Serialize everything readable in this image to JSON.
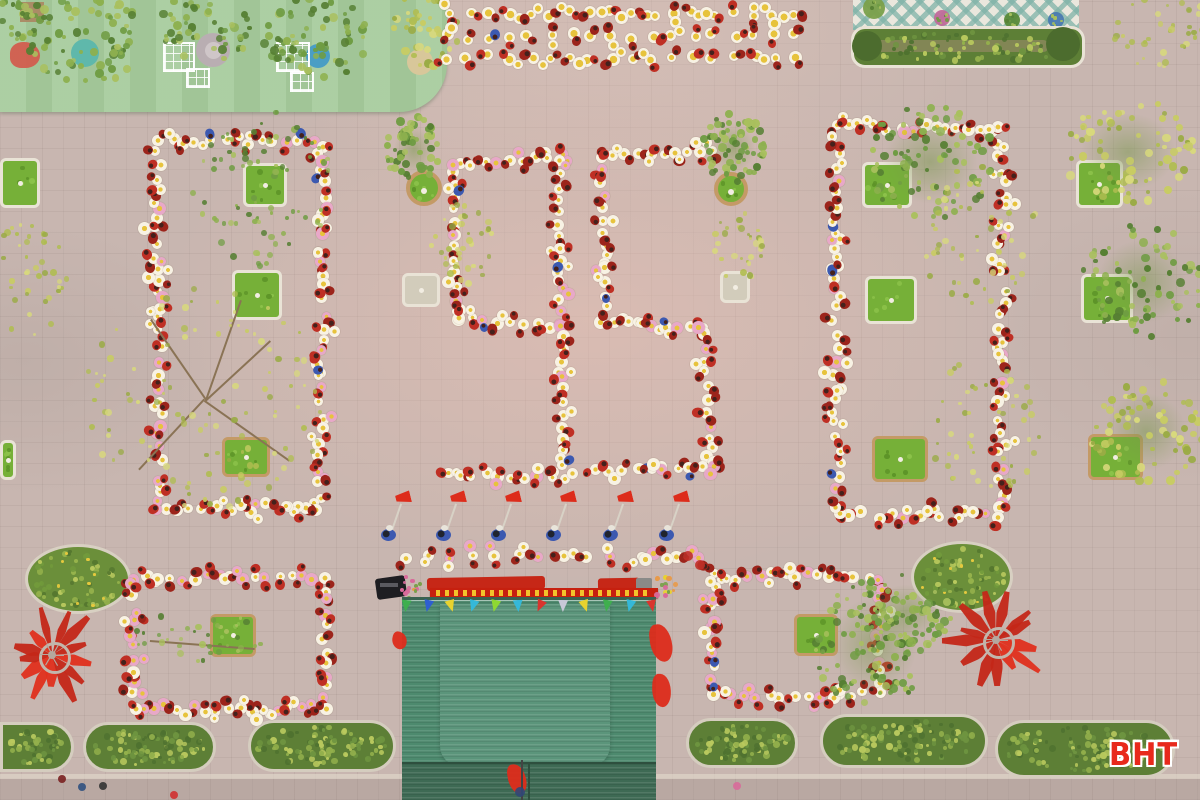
{
  "meta": {
    "watermark": "BHT",
    "scene_description": "Aerial drone photograph of schoolchildren in red outfits holding white and yellow flower props, arranged on a pink-grey paved schoolyard to form the number 95, flanked by rectangular student formations around tree planters, with a green corrugated stage roof, flag bearers, hedges, round shrub planters and red fan decorations"
  },
  "palette": {
    "paving": "#c8b6b0",
    "playground_mat": "#a6cb9c",
    "grass": "#76b038",
    "grass_dark": "#5d9428",
    "curb_white": "#e9e3d6",
    "curb_tan": "#c49a66",
    "hedge_base": "#5d7f36",
    "hedge_greens": [
      "#4f7230",
      "#6e9440",
      "#93b04c",
      "#b9c95e"
    ],
    "bush_base": "#6b8f3a",
    "bush_greens": [
      "#55772f",
      "#729a3c",
      "#97b34c",
      "#b9c95e"
    ],
    "bush_flower": "#e5c93e",
    "tree_green": [
      "#6f9c43",
      "#8db04e",
      "#567f33",
      "#a9c05e"
    ],
    "tree_yellow": [
      "#c8cc63",
      "#b0bd51",
      "#d8d97c",
      "#9aab45"
    ],
    "student_red": "#bf2f24",
    "student_red_dark": "#9c241b",
    "student_head": "#44211c",
    "student_blue": "#3c59b0",
    "flower_white": "#f8f2e4",
    "flower_pink": "#e8a8c8",
    "flower_yellow": "#e7c33c",
    "flag_red": "#dd2c1b",
    "roof": "#4d8a6e",
    "roof_light": "#5b957b",
    "roof_dark": "#3e6a54",
    "roof_seam": "#2e4f3e",
    "banner_red": "#c6200f",
    "banner_gold": "#f2c32c",
    "patio_bg": "#eae7dd",
    "patio_tile": "#7fb3a8",
    "branch": "#8a7355",
    "pole_grey": "#d8d2c6",
    "watermark_red": "#e8291c"
  },
  "scene": {
    "playground": {
      "x": 0,
      "y": 0,
      "w": 447,
      "h": 112,
      "radius_br": 48,
      "circles": [
        {
          "cx": 213,
          "cy": 50,
          "r": 17,
          "fill": "#b9aeb2",
          "inner": "#cfc6c8"
        },
        {
          "cx": 85,
          "cy": 53,
          "r": 14,
          "fill": "#5fb8ab"
        },
        {
          "cx": 318,
          "cy": 56,
          "r": 12,
          "fill": "#4a9ec4"
        },
        {
          "cx": 420,
          "cy": 62,
          "r": 13,
          "fill": "#d8c79a"
        }
      ],
      "frames": [
        {
          "x": 163,
          "y": 42,
          "w": 32,
          "h": 30
        },
        {
          "x": 276,
          "y": 42,
          "w": 34,
          "h": 30
        },
        {
          "x": 186,
          "y": 68,
          "w": 24,
          "h": 20
        },
        {
          "x": 290,
          "y": 72,
          "w": 24,
          "h": 20
        }
      ],
      "blobs": [
        {
          "cx": 88,
          "cy": 40,
          "rx": 60,
          "ry": 44,
          "pal": "tree_green",
          "n": 70
        },
        {
          "cx": 205,
          "cy": 26,
          "rx": 50,
          "ry": 36,
          "pal": "tree_green",
          "n": 55
        },
        {
          "cx": 315,
          "cy": 36,
          "rx": 56,
          "ry": 44,
          "pal": "tree_green",
          "n": 70
        },
        {
          "cx": 428,
          "cy": 28,
          "rx": 36,
          "ry": 40,
          "pal": "tree_yellow",
          "n": 45
        },
        {
          "cx": 18,
          "cy": 18,
          "rx": 26,
          "ry": 22,
          "pal": "tree_green",
          "n": 25
        }
      ],
      "red_item": {
        "x": 10,
        "y": 42,
        "w": 30,
        "h": 26
      },
      "brown_box": {
        "x": 20,
        "y": 2,
        "w": 24,
        "h": 20
      }
    },
    "patio": {
      "x": 853,
      "y": 0,
      "w": 226,
      "h": 30,
      "pots": [
        {
          "cx": 874,
          "cy": 8,
          "r": 11,
          "fill": "#7aa04a"
        },
        {
          "cx": 942,
          "cy": 18,
          "r": 8,
          "fill": "#c06a9a"
        },
        {
          "cx": 1012,
          "cy": 20,
          "r": 8,
          "fill": "#5a8a3a"
        },
        {
          "cx": 1056,
          "cy": 20,
          "r": 8,
          "fill": "#4a7ab0"
        }
      ],
      "hedge": {
        "x": 851,
        "y": 26,
        "w": 234,
        "h": 42,
        "seed": 55
      }
    },
    "round_planters": [
      {
        "cx": 424,
        "cy": 188,
        "r": 18
      },
      {
        "cx": 731,
        "cy": 189,
        "r": 17
      }
    ],
    "square_planters": [
      {
        "x": 0,
        "y": 158,
        "w": 40,
        "h": 50,
        "curb": "white"
      },
      {
        "x": 0,
        "y": 440,
        "w": 16,
        "h": 40,
        "curb": "white"
      },
      {
        "x": 243,
        "y": 163,
        "w": 44,
        "h": 44,
        "curb": "white"
      },
      {
        "x": 232,
        "y": 270,
        "w": 50,
        "h": 50,
        "curb": "white"
      },
      {
        "x": 222,
        "y": 437,
        "w": 48,
        "h": 40,
        "curb": "tan"
      },
      {
        "x": 402,
        "y": 273,
        "w": 38,
        "h": 34,
        "curb": "white",
        "bare": true
      },
      {
        "x": 720,
        "y": 271,
        "w": 30,
        "h": 32,
        "curb": "white",
        "bare": true
      },
      {
        "x": 862,
        "y": 162,
        "w": 50,
        "h": 46,
        "curb": "white"
      },
      {
        "x": 865,
        "y": 276,
        "w": 52,
        "h": 48,
        "curb": "white"
      },
      {
        "x": 872,
        "y": 436,
        "w": 56,
        "h": 46,
        "curb": "tan"
      },
      {
        "x": 1076,
        "y": 160,
        "w": 47,
        "h": 48,
        "curb": "white"
      },
      {
        "x": 1081,
        "y": 274,
        "w": 52,
        "h": 49,
        "curb": "white"
      },
      {
        "x": 1088,
        "y": 434,
        "w": 55,
        "h": 46,
        "curb": "tan"
      },
      {
        "x": 210,
        "y": 614,
        "w": 46,
        "h": 43,
        "curb": "tan"
      },
      {
        "x": 794,
        "y": 614,
        "w": 44,
        "h": 42,
        "curb": "tan"
      }
    ],
    "bushes": [
      {
        "cx": 78,
        "cy": 579,
        "rx": 53,
        "ry": 35,
        "seed": 61
      },
      {
        "cx": 962,
        "cy": 577,
        "rx": 51,
        "ry": 36,
        "seed": 62
      }
    ],
    "hedges": [
      {
        "x": 0,
        "y": 722,
        "w": 74,
        "h": 50,
        "seed": 71,
        "flatLeft": true
      },
      {
        "x": 83,
        "y": 722,
        "w": 133,
        "h": 50,
        "seed": 72
      },
      {
        "x": 248,
        "y": 720,
        "w": 148,
        "h": 52,
        "seed": 73
      },
      {
        "x": 686,
        "y": 718,
        "w": 112,
        "h": 50,
        "seed": 74
      },
      {
        "x": 820,
        "y": 714,
        "w": 168,
        "h": 54,
        "seed": 75
      },
      {
        "x": 995,
        "y": 720,
        "w": 180,
        "h": 58,
        "seed": 76
      }
    ],
    "bottom_strip": {
      "y": 779,
      "h": 21,
      "curb_y": 774,
      "curb_h": 5
    },
    "stage": {
      "red_cloths": [
        {
          "x": 427,
          "y": 577,
          "w": 118,
          "h": 13
        },
        {
          "x": 598,
          "y": 578,
          "w": 42,
          "h": 15
        }
      ],
      "banner": {
        "x": 430,
        "y": 588,
        "w": 228,
        "h": 10
      },
      "bouquets": [
        {
          "cx": 412,
          "cy": 586,
          "r": 13
        },
        {
          "cx": 664,
          "cy": 586,
          "r": 12
        }
      ],
      "speaker": {
        "x": 376,
        "y": 577,
        "w": 30,
        "h": 21
      },
      "gray_box": {
        "x": 636,
        "y": 578,
        "w": 16,
        "h": 12
      },
      "roof": {
        "x": 402,
        "y": 600,
        "w": 254,
        "h": 200
      },
      "roof_inner": {
        "x": 440,
        "y": 604,
        "w": 170,
        "h": 162
      },
      "roof_bottom": {
        "x": 402,
        "y": 762,
        "w": 254,
        "h": 38
      },
      "seam_x": 528,
      "bunting": {
        "y": 600,
        "x1": 406,
        "x2": 652,
        "colors": [
          "#3faf4e",
          "#2e5fd0",
          "#e8d22e",
          "#35b8d8",
          "#8fd832",
          "#35b8d8",
          "#d8352e",
          "#c8c8d8",
          "#e8d22e",
          "#3faf4e",
          "#35b8d8",
          "#d8352e"
        ]
      },
      "red_patches": [
        {
          "x": 392,
          "y": 632,
          "w": 15,
          "h": 17
        },
        {
          "x": 650,
          "y": 624,
          "w": 22,
          "h": 38
        },
        {
          "x": 652,
          "y": 674,
          "w": 19,
          "h": 33
        },
        {
          "x": 508,
          "y": 764,
          "w": 18,
          "h": 30
        }
      ],
      "pole": {
        "x": 521,
        "y": 760,
        "w": 2,
        "h": 40
      }
    },
    "formations": [
      {
        "name": "left-block",
        "x": 158,
        "y": 140,
        "w": 164,
        "h": 368,
        "spacing": 13,
        "jitter": 5,
        "seed": 11,
        "pink": 0.18
      },
      {
        "name": "right-block",
        "x": 836,
        "y": 128,
        "w": 166,
        "h": 386,
        "spacing": 13,
        "jitter": 5,
        "seed": 22,
        "pink": 0.18
      },
      {
        "name": "bottom-left-block",
        "x": 133,
        "y": 578,
        "w": 192,
        "h": 130,
        "spacing": 12,
        "jitter": 4,
        "seed": 33,
        "pink": 0.4
      },
      {
        "name": "bottom-right-block",
        "x": 712,
        "y": 576,
        "w": 168,
        "h": 118,
        "spacing": 12,
        "jitter": 4,
        "seed": 44,
        "pink": 0.4
      }
    ],
    "digits": {
      "value": "95",
      "segments": [
        {
          "digit": "9",
          "x1": 458,
          "y1": 166,
          "x2": 562,
          "y2": 156,
          "n": 9
        },
        {
          "digit": "9",
          "x1": 455,
          "y1": 170,
          "x2": 456,
          "y2": 312,
          "n": 12
        },
        {
          "digit": "9",
          "x1": 458,
          "y1": 318,
          "x2": 550,
          "y2": 326,
          "n": 8
        },
        {
          "digit": "9",
          "x1": 558,
          "y1": 162,
          "x2": 564,
          "y2": 464,
          "n": 25
        },
        {
          "digit": "9",
          "x1": 447,
          "y1": 474,
          "x2": 564,
          "y2": 479,
          "n": 10
        },
        {
          "digit": "5",
          "x1": 600,
          "y1": 156,
          "x2": 714,
          "y2": 151,
          "n": 10
        },
        {
          "digit": "5",
          "x1": 602,
          "y1": 168,
          "x2": 608,
          "y2": 308,
          "n": 12
        },
        {
          "digit": "5",
          "x1": 602,
          "y1": 320,
          "x2": 702,
          "y2": 328,
          "n": 9
        },
        {
          "digit": "5",
          "x1": 704,
          "y1": 336,
          "x2": 712,
          "y2": 462,
          "n": 11
        },
        {
          "digit": "5",
          "x1": 597,
          "y1": 471,
          "x2": 716,
          "y2": 467,
          "n": 10
        }
      ]
    },
    "top_rows": {
      "x1": 448,
      "x2": 795,
      "ys": [
        14,
        36,
        58
      ],
      "n": 18,
      "seed": 81
    },
    "flower_row": {
      "x1": 404,
      "x2": 700,
      "y": 557,
      "n": 14,
      "seed": 82
    },
    "flag_bearers": {
      "xs": [
        388,
        443,
        498,
        553,
        610,
        666
      ],
      "y": 534
    },
    "fans": [
      {
        "cx": 52,
        "cy": 655,
        "r": 48,
        "petals": 13,
        "seed": 91
      },
      {
        "cx": 996,
        "cy": 640,
        "r": 50,
        "petals": 13,
        "seed": 92
      }
    ],
    "trees": [
      {
        "cx": 414,
        "cy": 150,
        "rx": 28,
        "ry": 33,
        "pal": "tree_green",
        "n": 60
      },
      {
        "cx": 462,
        "cy": 242,
        "rx": 34,
        "ry": 42,
        "pal": "tree_yellow",
        "n": 40,
        "sparse": true
      },
      {
        "cx": 733,
        "cy": 148,
        "rx": 31,
        "ry": 35,
        "pal": "tree_green",
        "n": 65
      },
      {
        "cx": 737,
        "cy": 246,
        "rx": 26,
        "ry": 38,
        "pal": "tree_yellow",
        "n": 32,
        "sparse": true
      },
      {
        "cx": 262,
        "cy": 188,
        "rx": 72,
        "ry": 78,
        "pal": "tree_green",
        "n": 80,
        "sparse": true
      },
      {
        "cx": 205,
        "cy": 400,
        "rx": 122,
        "ry": 112,
        "pal": "tree_yellow",
        "n": 110,
        "sparse": true,
        "branches": [
          [
            205,
            400,
            150,
            320
          ],
          [
            205,
            400,
            270,
            340
          ],
          [
            205,
            400,
            140,
            470
          ],
          [
            205,
            400,
            290,
            460
          ],
          [
            205,
            400,
            240,
            300
          ]
        ]
      },
      {
        "cx": 28,
        "cy": 282,
        "rx": 42,
        "ry": 60,
        "pal": "tree_yellow",
        "n": 45,
        "sparse": true
      },
      {
        "cx": 930,
        "cy": 162,
        "rx": 66,
        "ry": 58,
        "pal": "tree_green",
        "n": 85
      },
      {
        "cx": 978,
        "cy": 235,
        "rx": 62,
        "ry": 72,
        "pal": "tree_yellow",
        "n": 55,
        "sparse": true
      },
      {
        "cx": 985,
        "cy": 425,
        "rx": 58,
        "ry": 68,
        "pal": "tree_yellow",
        "n": 50,
        "sparse": true
      },
      {
        "cx": 1128,
        "cy": 152,
        "rx": 66,
        "ry": 54,
        "pal": "tree_yellow",
        "n": 75
      },
      {
        "cx": 1142,
        "cy": 282,
        "rx": 62,
        "ry": 58,
        "pal": "tree_green",
        "n": 80
      },
      {
        "cx": 1146,
        "cy": 432,
        "rx": 56,
        "ry": 54,
        "pal": "tree_yellow",
        "n": 70
      },
      {
        "cx": 1162,
        "cy": 30,
        "rx": 50,
        "ry": 40,
        "pal": "tree_yellow",
        "n": 40,
        "sparse": true
      },
      {
        "cx": 200,
        "cy": 636,
        "rx": 66,
        "ry": 26,
        "pal": "tree_green",
        "n": 35,
        "sparse": true,
        "branches": [
          [
            150,
            640,
            255,
            648
          ]
        ]
      },
      {
        "cx": 874,
        "cy": 645,
        "rx": 60,
        "ry": 66,
        "pal": "tree_green",
        "n": 110
      },
      {
        "cx": 906,
        "cy": 612,
        "rx": 48,
        "ry": 38,
        "pal": "tree_green",
        "n": 55
      }
    ],
    "dots": [
      {
        "x": 62,
        "y": 779,
        "r": 4,
        "fill": "#7a2020"
      },
      {
        "x": 82,
        "y": 787,
        "r": 4,
        "fill": "#305080"
      },
      {
        "x": 103,
        "y": 786,
        "r": 4,
        "fill": "#333333"
      },
      {
        "x": 688,
        "y": 556,
        "r": 5,
        "fill": "#c03028"
      },
      {
        "x": 700,
        "y": 565,
        "r": 5,
        "fill": "#c03028"
      },
      {
        "x": 737,
        "y": 786,
        "r": 4,
        "fill": "#d86a9a"
      },
      {
        "x": 174,
        "y": 795,
        "r": 4,
        "fill": "#d03030"
      },
      {
        "x": 520,
        "y": 792,
        "r": 5,
        "fill": "#304878"
      }
    ]
  }
}
